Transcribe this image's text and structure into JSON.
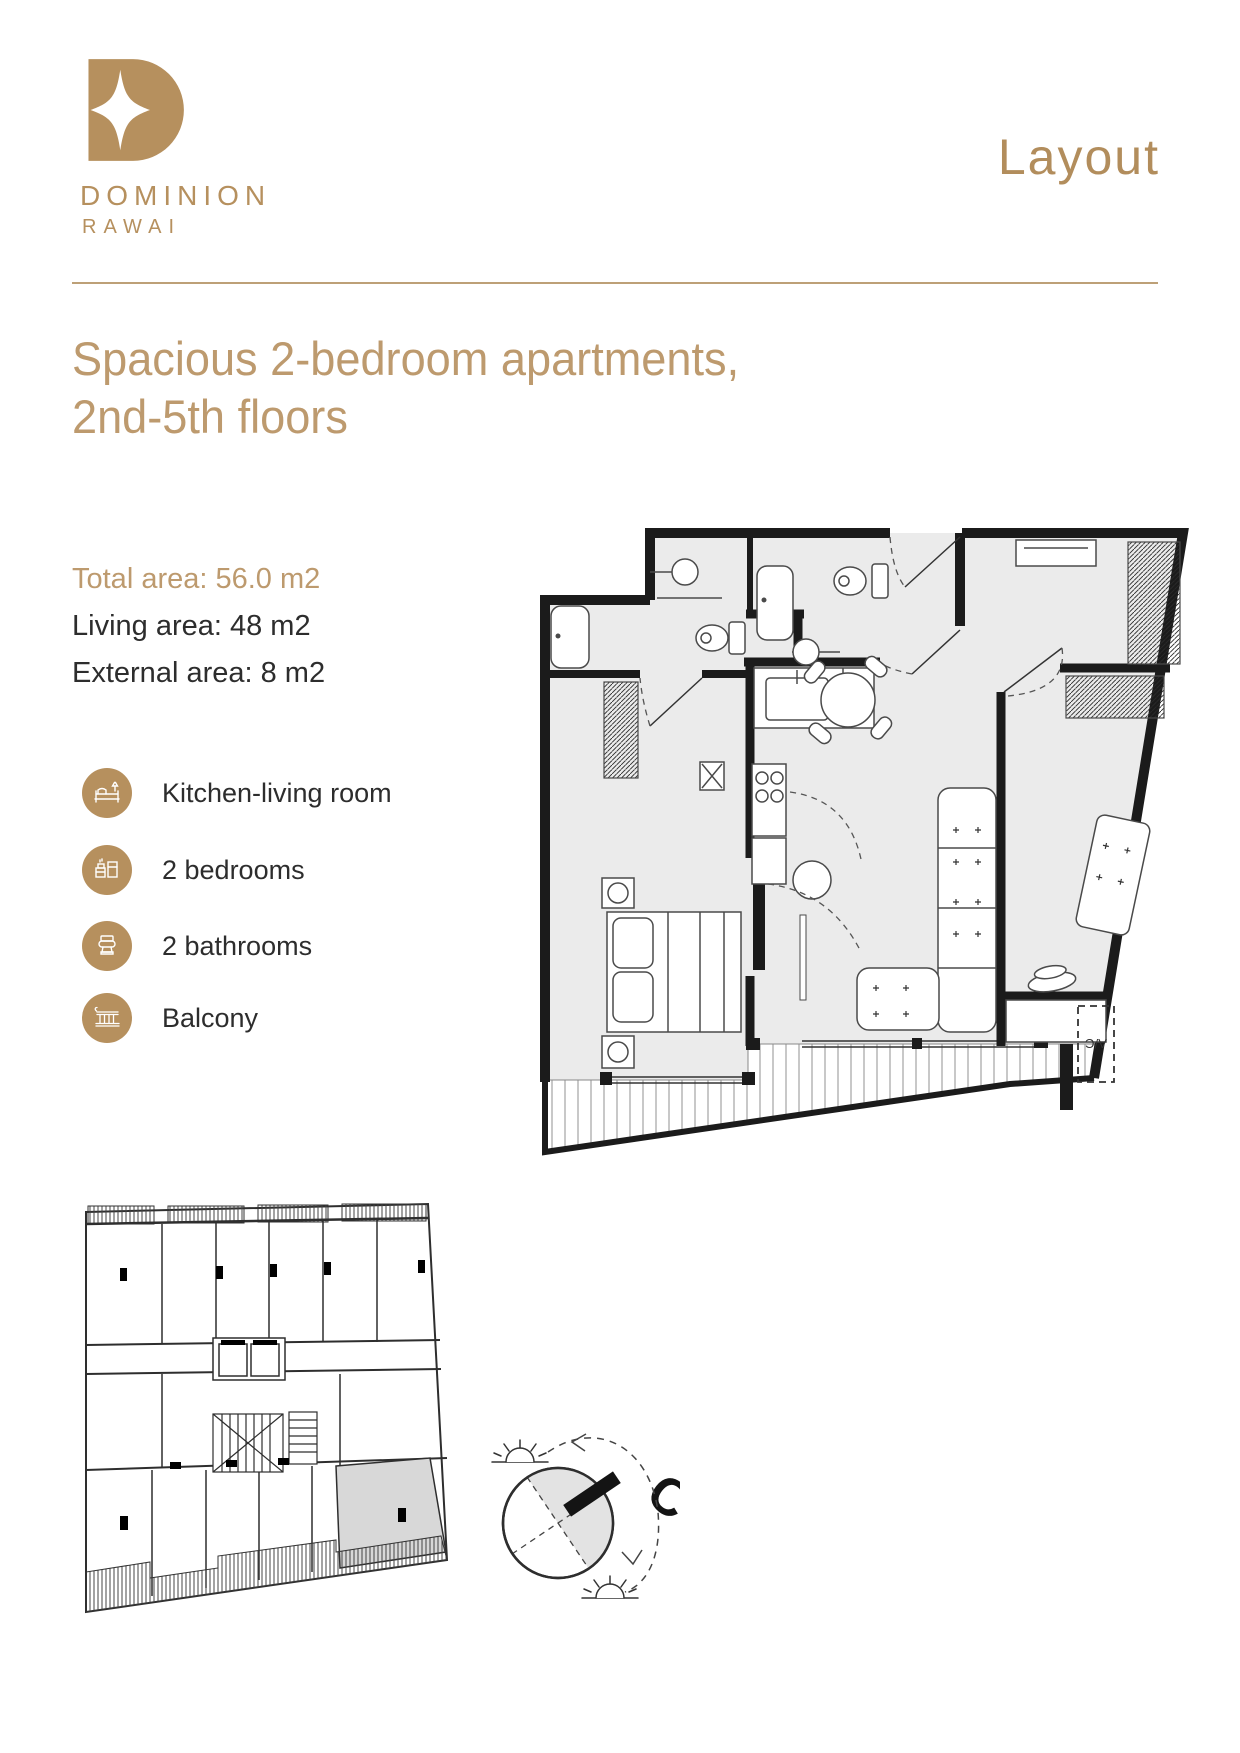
{
  "colors": {
    "gold": "#b6905e",
    "gold_light": "#bd9a6e",
    "divider": "#bda077",
    "text_dark": "#2d2d2d",
    "plan_wall": "#1b1b1b",
    "plan_floor": "#ebebeb",
    "unit_highlight": "#d8d8d8"
  },
  "brand": {
    "name": "DOMINION",
    "location": "RAWAI"
  },
  "header": {
    "page_title": "Layout"
  },
  "listing": {
    "title_line1": "Spacious 2-bedroom apartments,",
    "title_line2": "2nd-5th floors",
    "areas": [
      {
        "label": "Total area: 56.0 m2"
      },
      {
        "label": "Living area: 48 m2"
      },
      {
        "label": "External area: 8 m2"
      }
    ]
  },
  "features": [
    {
      "label": "Kitchen-living room",
      "icon": "bed-icon"
    },
    {
      "label": "2 bedrooms",
      "icon": "kitchen-icon"
    },
    {
      "label": "2 bathrooms",
      "icon": "toilet-icon"
    },
    {
      "label": "Balcony",
      "icon": "balcony-icon"
    }
  ],
  "floor_plan": {
    "ac_label": "A/C"
  },
  "compass": {
    "north_label": "С"
  }
}
